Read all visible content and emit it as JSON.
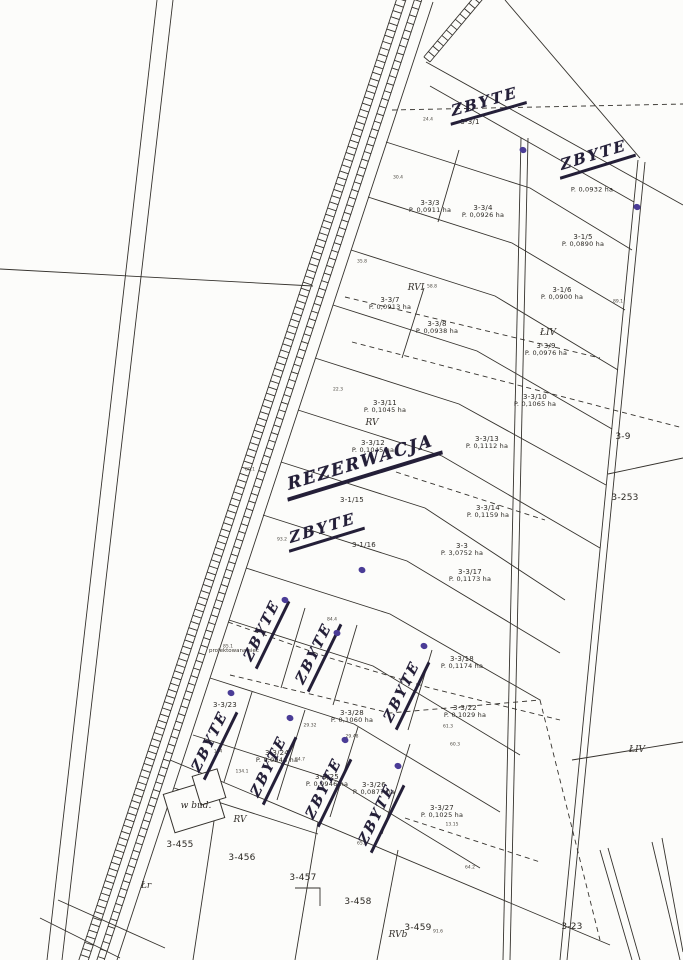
{
  "document": {
    "kind": "cadastral parcel map scan"
  },
  "annotations": {
    "building_note": "w bud.",
    "road_note": "projektowana sieć"
  },
  "handwriting": {
    "ink_color": "#241f38",
    "dot_color": "#4a3c96",
    "sold_text": "ZBYTE",
    "reservation_text": "REZERWACJA",
    "reservation": {
      "x": 283,
      "y": 476,
      "rot": -17
    },
    "flat_marks": [
      {
        "x": 447,
        "y": 103,
        "rot": -16
      },
      {
        "x": 556,
        "y": 157,
        "rot": -17
      },
      {
        "x": 285,
        "y": 530,
        "rot": -17
      }
    ],
    "rotated_marks": [
      {
        "x": 265,
        "y": 630
      },
      {
        "x": 317,
        "y": 653
      },
      {
        "x": 405,
        "y": 691
      },
      {
        "x": 213,
        "y": 741
      },
      {
        "x": 272,
        "y": 766
      },
      {
        "x": 327,
        "y": 788
      },
      {
        "x": 380,
        "y": 814
      }
    ],
    "dots": [
      {
        "x": 523,
        "y": 150
      },
      {
        "x": 637,
        "y": 207
      },
      {
        "x": 362,
        "y": 570
      },
      {
        "x": 285,
        "y": 600
      },
      {
        "x": 337,
        "y": 633
      },
      {
        "x": 424,
        "y": 646
      },
      {
        "x": 231,
        "y": 693
      },
      {
        "x": 290,
        "y": 718
      },
      {
        "x": 345,
        "y": 740
      },
      {
        "x": 398,
        "y": 766
      }
    ]
  },
  "parcels": [
    {
      "id": "3-3/1",
      "area": "",
      "x": 470,
      "y": 122
    },
    {
      "id": "",
      "area": "P. 0,0932 ha",
      "x": 592,
      "y": 190
    },
    {
      "id": "3-3/3",
      "area": "P. 0,0911 ha",
      "x": 430,
      "y": 207
    },
    {
      "id": "3-3/4",
      "area": "P. 0,0926 ha",
      "x": 483,
      "y": 212
    },
    {
      "id": "3-1/5",
      "area": "P. 0,0890 ha",
      "x": 583,
      "y": 241
    },
    {
      "id": "3-1/6",
      "area": "P. 0,0900 ha",
      "x": 562,
      "y": 294
    },
    {
      "id": "3-3/7",
      "area": "P. 0,0913 ha",
      "x": 390,
      "y": 304
    },
    {
      "id": "3-3/8",
      "area": "P. 0,0938 ha",
      "x": 437,
      "y": 328
    },
    {
      "id": "3-3/9",
      "area": "P. 0,0976 ha",
      "x": 546,
      "y": 350
    },
    {
      "id": "3-3/10",
      "area": "P. 0,1065 ha",
      "x": 535,
      "y": 401
    },
    {
      "id": "3-3/11",
      "area": "P. 0,1045 ha",
      "x": 385,
      "y": 407
    },
    {
      "id": "3-3/12",
      "area": "P. 0,1045 ha",
      "x": 373,
      "y": 447
    },
    {
      "id": "3-3/13",
      "area": "P. 0,1112 ha",
      "x": 487,
      "y": 443
    },
    {
      "id": "3-3/14",
      "area": "P. 0,1159 ha",
      "x": 488,
      "y": 512
    },
    {
      "id": "3-1/15",
      "area": "",
      "x": 352,
      "y": 500
    },
    {
      "id": "3-1/16",
      "area": "",
      "x": 364,
      "y": 545
    },
    {
      "id": "3-3",
      "area": "P. 3,0752 ha",
      "x": 462,
      "y": 550
    },
    {
      "id": "3-3/17",
      "area": "P. 0,1173 ha",
      "x": 470,
      "y": 576
    },
    {
      "id": "3-3/18",
      "area": "P. 0,1174 ha",
      "x": 462,
      "y": 663
    },
    {
      "id": "3-3/22",
      "area": "P. 0,1029 ha",
      "x": 465,
      "y": 712
    },
    {
      "id": "3-3/28",
      "area": "P. 0,1060 ha",
      "x": 352,
      "y": 717
    },
    {
      "id": "3-3/23",
      "area": "",
      "x": 225,
      "y": 705
    },
    {
      "id": "3-3/24",
      "area": "P. 0,0946 ha",
      "x": 277,
      "y": 757
    },
    {
      "id": "3-3/25",
      "area": "P. 0,0946 ha",
      "x": 327,
      "y": 781
    },
    {
      "id": "3-3/26",
      "area": "P. 0,0877 ha",
      "x": 374,
      "y": 789
    },
    {
      "id": "3-3/27",
      "area": "P. 0,1025 ha",
      "x": 442,
      "y": 812
    },
    {
      "id": "3-9",
      "area": "",
      "x": 623,
      "y": 437,
      "s": 9
    },
    {
      "id": "3-253",
      "area": "",
      "x": 625,
      "y": 498,
      "s": 9
    },
    {
      "id": "3-455",
      "area": "",
      "x": 180,
      "y": 845,
      "s": 9
    },
    {
      "id": "3-456",
      "area": "",
      "x": 242,
      "y": 858,
      "s": 9
    },
    {
      "id": "3-457",
      "area": "",
      "x": 303,
      "y": 878,
      "s": 9
    },
    {
      "id": "3-458",
      "area": "",
      "x": 358,
      "y": 902,
      "s": 9
    },
    {
      "id": "3-459",
      "area": "",
      "x": 418,
      "y": 928,
      "s": 9
    },
    {
      "id": "3-23",
      "area": "",
      "x": 572,
      "y": 927,
      "s": 9
    }
  ],
  "zones": [
    {
      "t": "RVI",
      "x": 416,
      "y": 288
    },
    {
      "t": "ŁIV",
      "x": 548,
      "y": 333
    },
    {
      "t": "RV",
      "x": 372,
      "y": 423
    },
    {
      "t": "RV",
      "x": 240,
      "y": 820
    },
    {
      "t": "ŁIV",
      "x": 637,
      "y": 750
    },
    {
      "t": "RVb",
      "x": 398,
      "y": 935
    },
    {
      "t": "Łr",
      "x": 146,
      "y": 886
    }
  ],
  "tiny_numbers": [
    {
      "t": "24.4",
      "x": 428,
      "y": 120
    },
    {
      "t": "30.4",
      "x": 398,
      "y": 178
    },
    {
      "t": "35.8",
      "x": 362,
      "y": 262
    },
    {
      "t": "58.8",
      "x": 432,
      "y": 287
    },
    {
      "t": "89.1",
      "x": 618,
      "y": 302
    },
    {
      "t": "22.3",
      "x": 338,
      "y": 390
    },
    {
      "t": "80.1",
      "x": 250,
      "y": 470
    },
    {
      "t": "93.2",
      "x": 282,
      "y": 540
    },
    {
      "t": "85.1",
      "x": 228,
      "y": 647
    },
    {
      "t": "84.4",
      "x": 332,
      "y": 620
    },
    {
      "t": "61.3",
      "x": 448,
      "y": 727
    },
    {
      "t": "60.3",
      "x": 455,
      "y": 745
    },
    {
      "t": "104",
      "x": 218,
      "y": 752
    },
    {
      "t": "134.1",
      "x": 242,
      "y": 772
    },
    {
      "t": "29.32",
      "x": 310,
      "y": 726
    },
    {
      "t": "29.48",
      "x": 352,
      "y": 737
    },
    {
      "t": "84.7",
      "x": 300,
      "y": 760
    },
    {
      "t": "65.3",
      "x": 362,
      "y": 844
    },
    {
      "t": "13.15",
      "x": 452,
      "y": 825
    },
    {
      "t": "64.2",
      "x": 470,
      "y": 868
    },
    {
      "t": "91.6",
      "x": 438,
      "y": 932
    }
  ]
}
